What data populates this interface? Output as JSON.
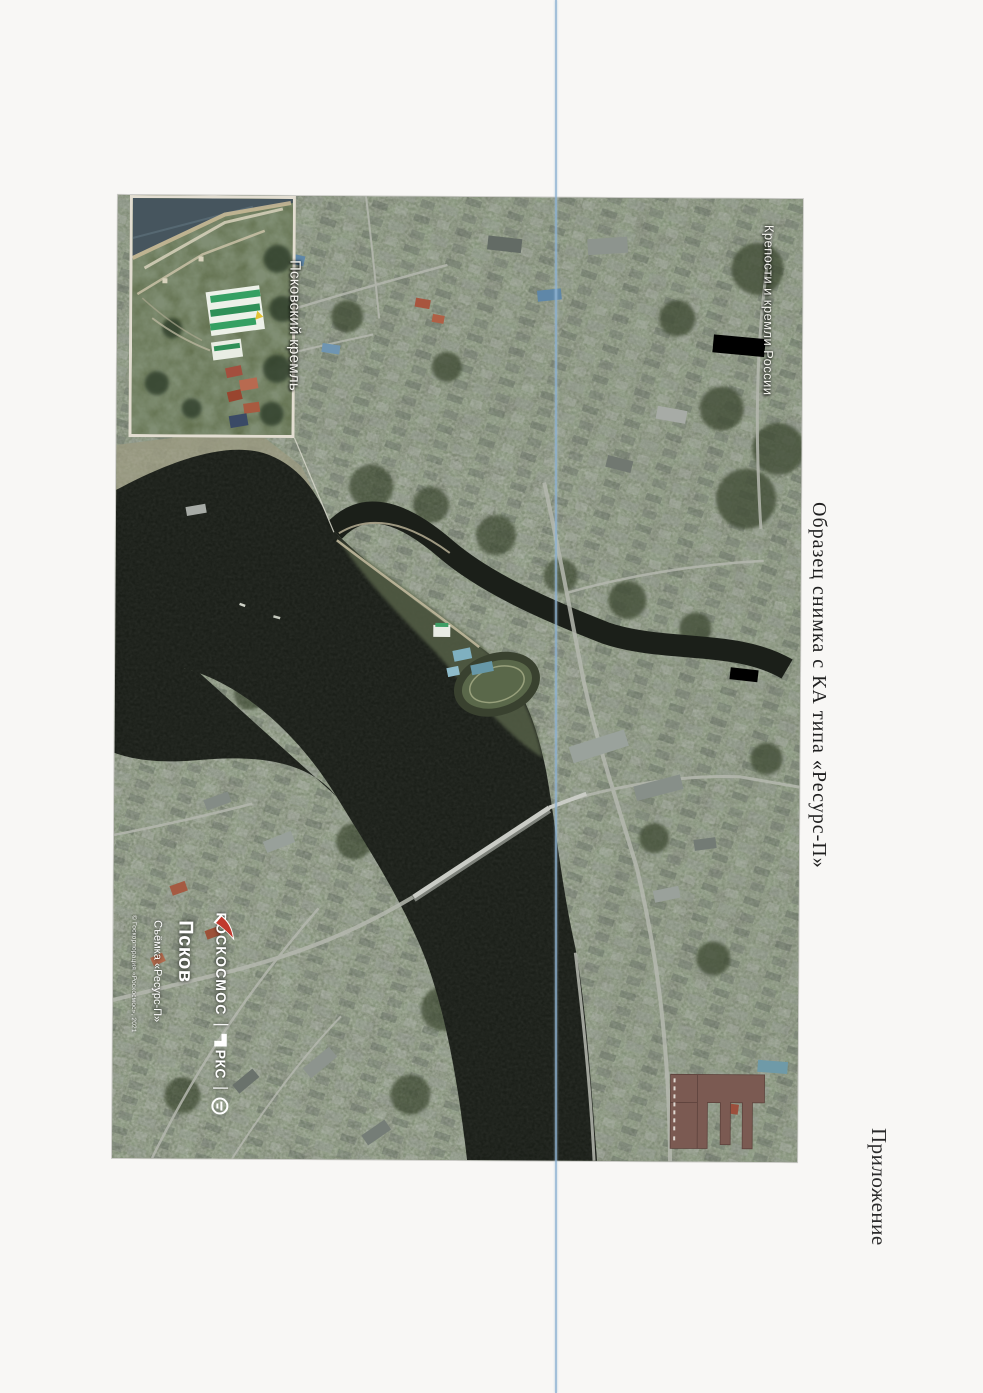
{
  "page": {
    "title": "Образец снимка с КА типа «Ресурс-П»",
    "corner_label": "Приложение"
  },
  "map": {
    "labels": {
      "series": "Крепости и кремли России",
      "kremlin": "Псковский кремль"
    },
    "watermark": {
      "city": "Псков",
      "caption": "Съёмка «Ресурс-П»",
      "copyright": "© Госкорпорация «Роскосмос», 2021",
      "agency": "РОСКОСМОС",
      "rks": "РКС",
      "separator": "|"
    },
    "colors": {
      "river": "#1b1f19",
      "land": "#7a8072",
      "roscosmos_red": "#c0392e",
      "fold_line": "#8fb3d3"
    }
  }
}
